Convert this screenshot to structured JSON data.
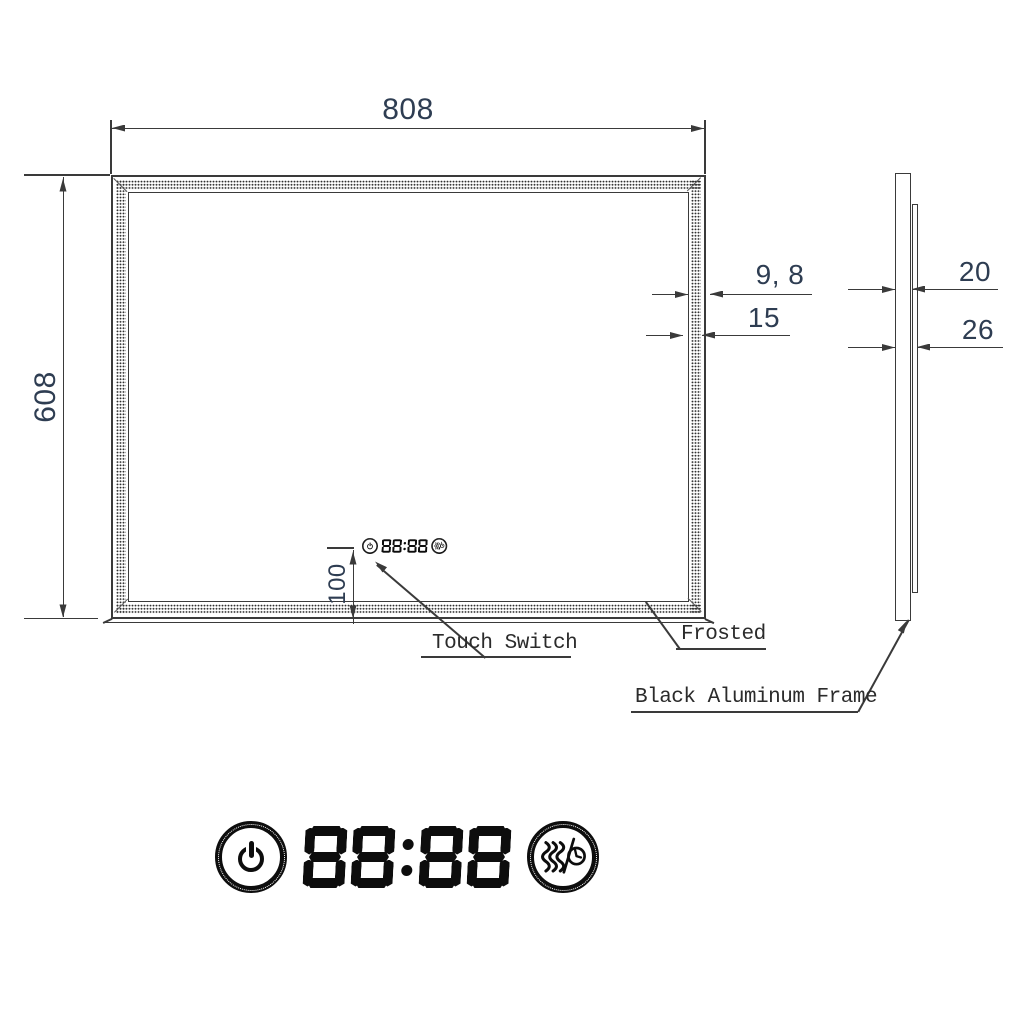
{
  "drawing_type": "mirror-technical-drawing",
  "front_view": {
    "width": "808",
    "height": "608",
    "frost_band_width": "9, 8",
    "frost_band_offset": "15",
    "switch_offset": "100",
    "touch_switch_label": "Touch Switch",
    "frosted_label": "Frosted"
  },
  "side_view": {
    "frame_depth": "20",
    "total_depth": "26",
    "frame_label": "Black Aluminum Frame"
  },
  "control_panel": {
    "digits": "88:88",
    "power_icon": "power-icon",
    "defogger_icon": "defogger-timer-icon"
  },
  "colors": {
    "line": "#3a3a3a",
    "dimension_text": "#2e3d52",
    "label_text": "#2b2b2b",
    "icon": "#0d0d0d"
  }
}
